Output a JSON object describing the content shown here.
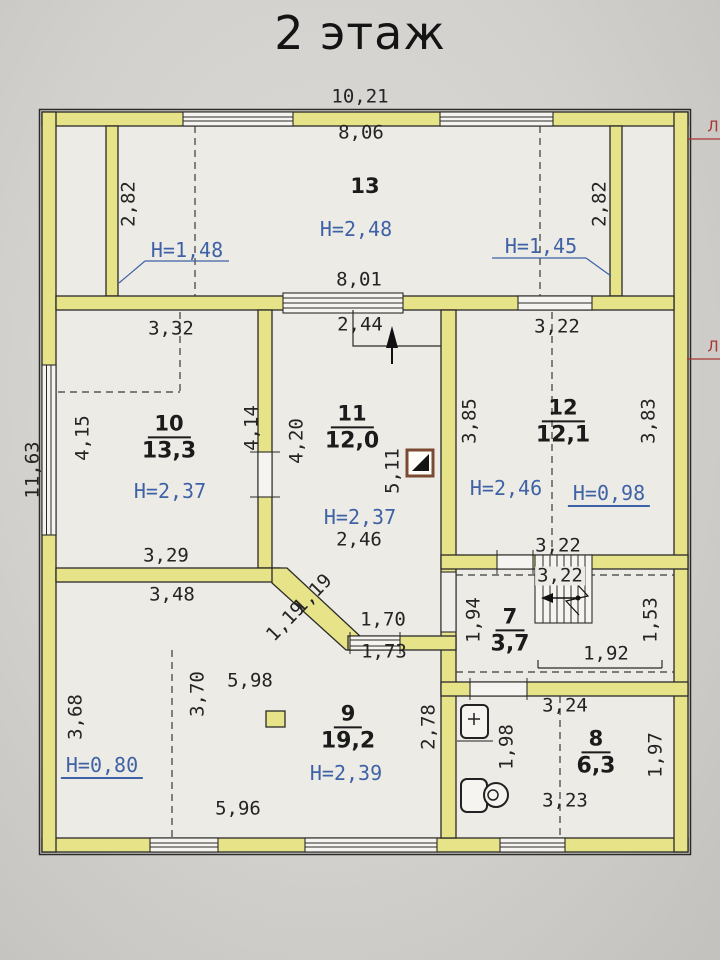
{
  "title": "2 этаж",
  "colors": {
    "wall": "#e7e388",
    "paper": "#d3d1cd",
    "floor": "#edebe6",
    "dimension_text": "#242424",
    "height_text": "#3e62a5",
    "red_mark": "#a83636"
  },
  "rooms": [
    {
      "number": "13",
      "area": "",
      "x": 365,
      "y": 187
    },
    {
      "number": "10",
      "area": "13,3",
      "x": 169,
      "y": 438
    },
    {
      "number": "11",
      "area": "12,0",
      "x": 352,
      "y": 428
    },
    {
      "number": "12",
      "area": "12,1",
      "x": 563,
      "y": 422
    },
    {
      "number": "7",
      "area": "3,7",
      "x": 510,
      "y": 631
    },
    {
      "number": "9",
      "area": "19,2",
      "x": 348,
      "y": 728
    },
    {
      "number": "8",
      "area": "6,3",
      "x": 596,
      "y": 753
    }
  ],
  "labels": [
    {
      "name": "dim-10-21",
      "text": "10,21",
      "x": 360,
      "y": 97,
      "rot": 0,
      "kind": "dim"
    },
    {
      "name": "dim-8-06",
      "text": "8,06",
      "x": 361,
      "y": 133,
      "rot": 0,
      "kind": "dim"
    },
    {
      "name": "dim-8-01",
      "text": "8,01",
      "x": 359,
      "y": 280,
      "rot": 0,
      "kind": "dim"
    },
    {
      "name": "dim-2-82-left",
      "text": "2,82",
      "x": 129,
      "y": 204,
      "rot": -90,
      "kind": "dim"
    },
    {
      "name": "dim-2-82-right",
      "text": "2,82",
      "x": 600,
      "y": 204,
      "rot": -90,
      "kind": "dim"
    },
    {
      "name": "height-2-48",
      "text": "H=2,48",
      "x": 356,
      "y": 229,
      "rot": 0,
      "kind": "height"
    },
    {
      "name": "height-1-48",
      "text": "H=1,48",
      "x": 187,
      "y": 250,
      "rot": 0,
      "kind": "height"
    },
    {
      "name": "height-1-45",
      "text": "H=1,45",
      "x": 541,
      "y": 246,
      "rot": 0,
      "kind": "height"
    },
    {
      "name": "dim-3-32",
      "text": "3,32",
      "x": 171,
      "y": 329,
      "rot": 0,
      "kind": "dim"
    },
    {
      "name": "dim-2-44",
      "text": "2,44",
      "x": 360,
      "y": 325,
      "rot": 0,
      "kind": "dim"
    },
    {
      "name": "dim-3-22-room12-top",
      "text": "3,22",
      "x": 557,
      "y": 327,
      "rot": 0,
      "kind": "dim"
    },
    {
      "name": "dim-4-15",
      "text": "4,15",
      "x": 83,
      "y": 438,
      "rot": -90,
      "kind": "dim"
    },
    {
      "name": "dim-11-63",
      "text": "11,63",
      "x": 33,
      "y": 470,
      "rot": -90,
      "kind": "dim"
    },
    {
      "name": "dim-4-14",
      "text": "4,14",
      "x": 252,
      "y": 428,
      "rot": -90,
      "kind": "dim"
    },
    {
      "name": "dim-4-20",
      "text": "4,20",
      "x": 297,
      "y": 441,
      "rot": -90,
      "kind": "dim"
    },
    {
      "name": "dim-5-11",
      "text": "5,11",
      "x": 393,
      "y": 471,
      "rot": -90,
      "kind": "dim"
    },
    {
      "name": "height-2-37-room10",
      "text": "H=2,37",
      "x": 170,
      "y": 491,
      "rot": 0,
      "kind": "height"
    },
    {
      "name": "height-2-37-room11",
      "text": "H=2,37",
      "x": 360,
      "y": 517,
      "rot": 0,
      "kind": "height"
    },
    {
      "name": "dim-2-46",
      "text": "2,46",
      "x": 359,
      "y": 540,
      "rot": 0,
      "kind": "dim"
    },
    {
      "name": "dim-3-85",
      "text": "3,85",
      "x": 470,
      "y": 421,
      "rot": -90,
      "kind": "dim"
    },
    {
      "name": "dim-3-83",
      "text": "3,83",
      "x": 649,
      "y": 421,
      "rot": -90,
      "kind": "dim"
    },
    {
      "name": "height-2-46",
      "text": "H=2,46",
      "x": 506,
      "y": 488,
      "rot": 0,
      "kind": "height"
    },
    {
      "name": "height-0-98",
      "text": "H=0,98",
      "x": 609,
      "y": 495,
      "rot": 0,
      "kind": "height-u"
    },
    {
      "name": "dim-3-22-room12-bottom",
      "text": "3,22",
      "x": 558,
      "y": 546,
      "rot": 0,
      "kind": "dim"
    },
    {
      "name": "dim-3-29",
      "text": "3,29",
      "x": 166,
      "y": 556,
      "rot": 0,
      "kind": "dim"
    },
    {
      "name": "dim-3-48",
      "text": "3,48",
      "x": 172,
      "y": 595,
      "rot": 0,
      "kind": "dim"
    },
    {
      "name": "dim-1-19-upper",
      "text": "1,19",
      "x": 313,
      "y": 594,
      "rot": -46,
      "kind": "dim"
    },
    {
      "name": "dim-1-19-lower",
      "text": "1,19",
      "x": 286,
      "y": 622,
      "rot": -46,
      "kind": "dim"
    },
    {
      "name": "dim-1-70",
      "text": "1,70",
      "x": 383,
      "y": 620,
      "rot": 0,
      "kind": "dim"
    },
    {
      "name": "dim-1-73",
      "text": "1,73",
      "x": 384,
      "y": 652,
      "rot": 0,
      "kind": "dim"
    },
    {
      "name": "dim-1-94",
      "text": "1,94",
      "x": 474,
      "y": 620,
      "rot": -90,
      "kind": "dim"
    },
    {
      "name": "dim-3-22-stair",
      "text": "3,22",
      "x": 560,
      "y": 576,
      "rot": 0,
      "kind": "dim bg"
    },
    {
      "name": "dim-1-92",
      "text": "1,92",
      "x": 606,
      "y": 654,
      "rot": 0,
      "kind": "dim"
    },
    {
      "name": "dim-1-53",
      "text": "1,53",
      "x": 651,
      "y": 620,
      "rot": -90,
      "kind": "dim"
    },
    {
      "name": "dim-3-68",
      "text": "3,68",
      "x": 76,
      "y": 717,
      "rot": -90,
      "kind": "dim"
    },
    {
      "name": "dim-3-70",
      "text": "3,70",
      "x": 198,
      "y": 694,
      "rot": -90,
      "kind": "dim"
    },
    {
      "name": "dim-5-98",
      "text": "5,98",
      "x": 250,
      "y": 681,
      "rot": 0,
      "kind": "dim"
    },
    {
      "name": "height-2-39",
      "text": "H=2,39",
      "x": 346,
      "y": 773,
      "rot": 0,
      "kind": "height"
    },
    {
      "name": "dim-2-78",
      "text": "2,78",
      "x": 429,
      "y": 727,
      "rot": -90,
      "kind": "dim"
    },
    {
      "name": "height-0-80",
      "text": "H=0,80",
      "x": 102,
      "y": 767,
      "rot": 0,
      "kind": "height-u"
    },
    {
      "name": "dim-5-96",
      "text": "5,96",
      "x": 238,
      "y": 809,
      "rot": 0,
      "kind": "dim"
    },
    {
      "name": "dim-1-98",
      "text": "1,98",
      "x": 507,
      "y": 747,
      "rot": -90,
      "kind": "dim"
    },
    {
      "name": "dim-3-24",
      "text": "3,24",
      "x": 565,
      "y": 706,
      "rot": 0,
      "kind": "dim"
    },
    {
      "name": "dim-1-97",
      "text": "1,97",
      "x": 656,
      "y": 755,
      "rot": -90,
      "kind": "dim"
    },
    {
      "name": "dim-3-23",
      "text": "3,23",
      "x": 565,
      "y": 801,
      "rot": 0,
      "kind": "dim"
    },
    {
      "name": "red-mark-top",
      "text": "Л",
      "x": 713,
      "y": 127,
      "rot": 0,
      "kind": "red"
    },
    {
      "name": "red-mark-middle",
      "text": "Л",
      "x": 713,
      "y": 347,
      "rot": 0,
      "kind": "red"
    }
  ]
}
